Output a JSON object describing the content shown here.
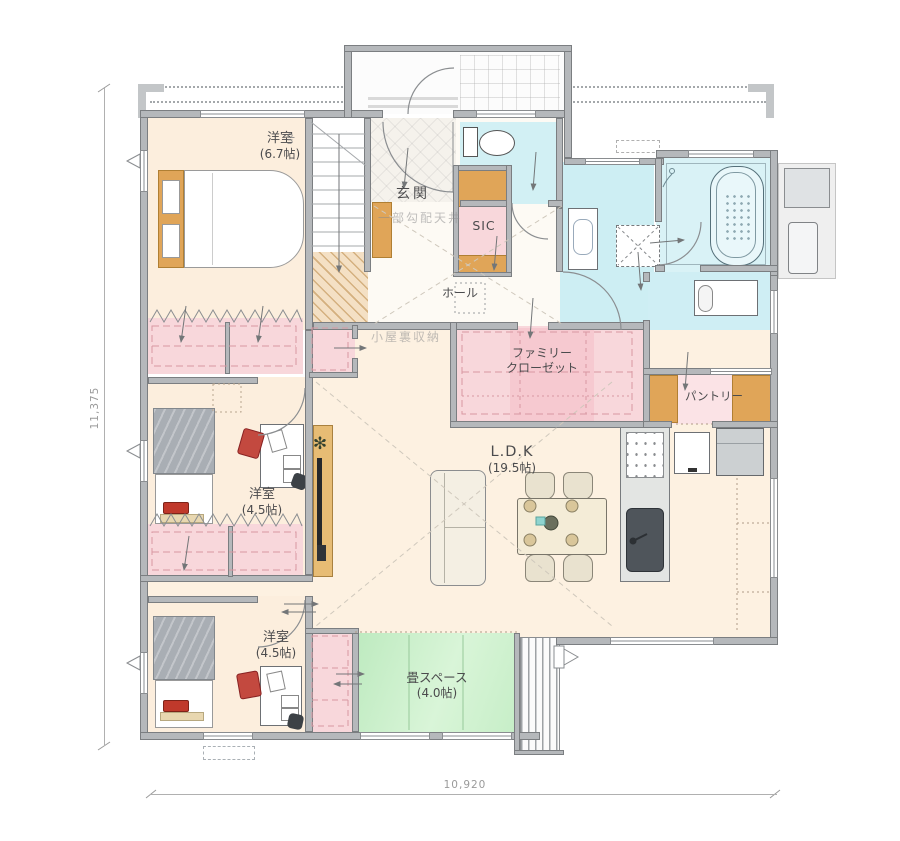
{
  "rooms": {
    "bedroom_main": {
      "name": "洋室",
      "size": "(6.7帖)"
    },
    "bedroom_mid": {
      "name": "洋室",
      "size": "(4.5帖)"
    },
    "bedroom_south": {
      "name": "洋室",
      "size": "(4.5帖)"
    },
    "ldk": {
      "name": "L.D.K",
      "size": "(19.5帖)"
    },
    "tatami": {
      "name": "畳スペース",
      "size": "(4.0帖)"
    },
    "entrance": {
      "name": "玄関"
    },
    "hall": {
      "name": "ホール"
    },
    "sic": {
      "name": "SIC"
    },
    "family_closet": {
      "line1": "ファミリー",
      "line2": "クローゼット"
    },
    "pantry": {
      "name": "パントリー"
    }
  },
  "annotations": {
    "stairs_direction": "up",
    "sloped_ceiling": "一部勾配天井",
    "attic_storage": "小屋裏収納"
  },
  "dimensions": {
    "vertical_mm": "11,375",
    "horizontal_mm": "10,920"
  },
  "colors": {
    "wall": "#b5b8bb",
    "floor_warm": "#fceedd",
    "closet_pink": "#f8d7db",
    "wet_blue": "#cdeef3",
    "tatami_green": "#cdefcf",
    "wood_shelf": "#e0a558"
  }
}
